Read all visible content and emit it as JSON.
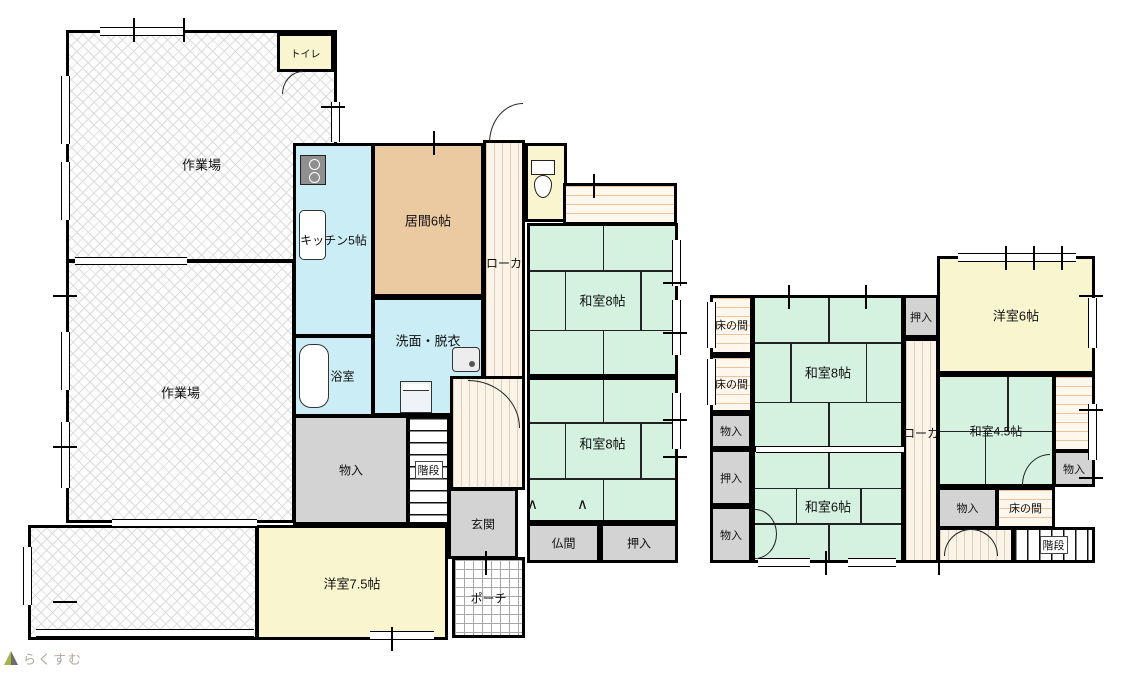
{
  "canvas": {
    "width": 1135,
    "height": 673
  },
  "logo": {
    "text": "らくすむ",
    "icon": "house-icon",
    "text_color": "#b3a69b"
  },
  "palette": {
    "tatami_green": "#d5f2e1",
    "water_cyan": "#cbedf5",
    "living_tan": "#ebc9a1",
    "western_cream": "#f9f5cf",
    "closet_gray": "#d3d3d3",
    "corridor_cream": "#f9f3e8",
    "engawa_stripe": "#edc49c",
    "wall_black": "#000000"
  },
  "floors": [
    {
      "id": "first-floor",
      "rooms": [
        {
          "id": "workshop-1",
          "label": "作業場",
          "type": "hatch",
          "rect": [
            66,
            30,
            271,
            232
          ],
          "ly": 58
        },
        {
          "id": "workshop-2",
          "label": "作業場",
          "type": "hatch",
          "rect": [
            66,
            260,
            229,
            263
          ]
        },
        {
          "id": "workshop-3",
          "label": "",
          "type": "hatch",
          "rect": [
            28,
            525,
            230,
            115
          ]
        },
        {
          "id": "toilet-upper",
          "label": "トイレ",
          "type": "cream",
          "rect": [
            277,
            33,
            57,
            39
          ],
          "fs": 10
        },
        {
          "id": "kitchen",
          "label": "キッチン5帖",
          "type": "cyan",
          "rect": [
            293,
            143,
            81,
            194
          ],
          "fs": 12
        },
        {
          "id": "living",
          "label": "居間6帖",
          "type": "tan",
          "rect": [
            372,
            143,
            112,
            154
          ]
        },
        {
          "id": "washroom",
          "label": "洗面・脱衣",
          "type": "cyan",
          "rect": [
            372,
            297,
            112,
            119
          ],
          "ly": 35
        },
        {
          "id": "bath",
          "label": "浴室",
          "type": "cyan",
          "rect": [
            293,
            335,
            81,
            82
          ],
          "fs": 12,
          "lx": 62
        },
        {
          "id": "corridor-1",
          "label": "ローカ",
          "type": "stripes-v",
          "rect": [
            483,
            140,
            42,
            278
          ],
          "ly": 44,
          "fs": 12
        },
        {
          "id": "hall-1",
          "label": "",
          "type": "stripes-v",
          "rect": [
            450,
            376,
            75,
            114
          ]
        },
        {
          "id": "toilet-lower",
          "label": "",
          "type": "cream",
          "rect": [
            525,
            143,
            42,
            79
          ]
        },
        {
          "id": "engawa-1",
          "label": "",
          "type": "stripes-h",
          "rect": [
            563,
            183,
            114,
            42
          ]
        },
        {
          "id": "washitsu-8-a",
          "label": "和室8帖",
          "type": "tatami tatami8",
          "rect": [
            527,
            223,
            151,
            154
          ]
        },
        {
          "id": "washitsu-8-b",
          "label": "和室8帖",
          "type": "tatami tatami8",
          "rect": [
            527,
            377,
            151,
            146
          ],
          "ly": 45
        },
        {
          "id": "storage-1f",
          "label": "物入",
          "type": "gray",
          "rect": [
            293,
            415,
            116,
            110
          ],
          "fs": 12
        },
        {
          "id": "stairs-1f",
          "label": "階段",
          "type": "stairs-h",
          "rect": [
            407,
            415,
            43,
            110
          ],
          "fs": 11,
          "boxed": true
        },
        {
          "id": "entrance",
          "label": "玄関",
          "type": "gray",
          "rect": [
            448,
            488,
            70,
            71
          ],
          "fs": 12
        },
        {
          "id": "porch",
          "label": "ポーチ",
          "type": "grid",
          "rect": [
            452,
            557,
            73,
            81
          ],
          "fs": 12
        },
        {
          "id": "western-7-5",
          "label": "洋室7.5帖",
          "type": "cream",
          "rect": [
            256,
            525,
            192,
            115
          ]
        },
        {
          "id": "butsuma",
          "label": "仏間",
          "type": "gray",
          "rect": [
            527,
            523,
            73,
            40
          ],
          "fs": 12
        },
        {
          "id": "oshiire-1f",
          "label": "押入",
          "type": "gray",
          "rect": [
            600,
            523,
            78,
            40
          ],
          "fs": 12
        }
      ]
    },
    {
      "id": "second-floor",
      "rooms": [
        {
          "id": "tokonoma-2f-a",
          "label": "床の間",
          "type": "stripes-h",
          "rect": [
            710,
            295,
            43,
            60
          ],
          "fs": 11
        },
        {
          "id": "tokonoma-2f-b",
          "label": "床の間",
          "type": "stripes-h",
          "rect": [
            710,
            355,
            43,
            58
          ],
          "fs": 11
        },
        {
          "id": "storage-2f-a",
          "label": "物入",
          "type": "gray",
          "rect": [
            710,
            413,
            42,
            36
          ],
          "fs": 11
        },
        {
          "id": "oshiire-2f-a",
          "label": "押入",
          "type": "gray",
          "rect": [
            710,
            449,
            42,
            57
          ],
          "fs": 11
        },
        {
          "id": "storage-2f-b",
          "label": "物入",
          "type": "gray",
          "rect": [
            710,
            506,
            42,
            57
          ],
          "fs": 11
        },
        {
          "id": "washitsu-8-c",
          "label": "和室8帖",
          "type": "tatami tatami8",
          "rect": [
            752,
            295,
            152,
            154
          ]
        },
        {
          "id": "washitsu-6",
          "label": "和室6帖",
          "type": "tatami tatami6",
          "rect": [
            752,
            449,
            152,
            114
          ]
        },
        {
          "id": "oshiire-2f-b",
          "label": "押入",
          "type": "gray",
          "rect": [
            903,
            295,
            36,
            43
          ],
          "fs": 11
        },
        {
          "id": "corridor-2",
          "label": "ローカ",
          "type": "stripes-v",
          "rect": [
            903,
            338,
            36,
            225
          ],
          "ly": 42,
          "fs": 12
        },
        {
          "id": "western-6",
          "label": "洋室6帖",
          "type": "cream",
          "rect": [
            937,
            256,
            158,
            118
          ]
        },
        {
          "id": "washitsu-4-5",
          "label": "和室4.5帖",
          "type": "tatami tatami45",
          "rect": [
            937,
            374,
            118,
            113
          ],
          "fs": 12
        },
        {
          "id": "engawa-2",
          "label": "",
          "type": "stripes-h",
          "rect": [
            1053,
            374,
            42,
            78
          ]
        },
        {
          "id": "storage-2f-c",
          "label": "物入",
          "type": "gray",
          "rect": [
            1053,
            450,
            42,
            37
          ],
          "fs": 11
        },
        {
          "id": "storage-2f-d",
          "label": "物入",
          "type": "gray",
          "rect": [
            937,
            487,
            61,
            42
          ],
          "fs": 11
        },
        {
          "id": "tokonoma-2f-c",
          "label": "床の間",
          "type": "stripes-h",
          "rect": [
            996,
            487,
            59,
            42
          ],
          "fs": 11
        },
        {
          "id": "hall-2",
          "label": "",
          "type": "stripes-v",
          "rect": [
            937,
            527,
            77,
            36
          ]
        },
        {
          "id": "stairs-2f",
          "label": "階段",
          "type": "stairs-v",
          "rect": [
            1012,
            527,
            83,
            36
          ],
          "fs": 11,
          "boxed": true
        }
      ]
    }
  ],
  "icons": [
    {
      "type": "stove",
      "rect": [
        300,
        155,
        26,
        30
      ]
    },
    {
      "type": "ksink",
      "rect": [
        299,
        210,
        27,
        50
      ]
    },
    {
      "type": "tub",
      "rect": [
        299,
        344,
        30,
        64
      ]
    },
    {
      "type": "basin",
      "rect": [
        452,
        347,
        28,
        25
      ]
    },
    {
      "type": "washer",
      "rect": [
        400,
        381,
        32,
        32
      ]
    },
    {
      "type": "toilet",
      "rect": [
        529,
        160,
        26,
        38
      ]
    }
  ],
  "doors": [
    {
      "rect": [
        489,
        103,
        34,
        40
      ],
      "corner": "tl"
    },
    {
      "rect": [
        282,
        71,
        21,
        23
      ],
      "corner": "tl"
    },
    {
      "rect": [
        468,
        380,
        52,
        48
      ],
      "corner": "tr"
    },
    {
      "rect": [
        1022,
        454,
        28,
        31
      ],
      "corner": "tl"
    },
    {
      "rect": [
        944,
        529,
        27,
        27
      ],
      "corner": "tl"
    },
    {
      "rect": [
        971,
        529,
        27,
        27
      ],
      "corner": "tr"
    },
    {
      "rect": [
        755,
        509,
        22,
        25
      ],
      "corner": "tr"
    },
    {
      "rect": [
        755,
        534,
        22,
        25
      ],
      "corner": "br"
    }
  ],
  "marks": [
    {
      "g": "∧",
      "x": 527,
      "y": 497
    },
    {
      "g": "∧",
      "x": 577,
      "y": 497
    }
  ],
  "windows": {
    "h": [
      [
        100,
        27,
        85,
        9
      ],
      [
        75,
        257,
        112,
        8
      ],
      [
        112,
        519,
        145,
        8
      ],
      [
        36,
        629,
        218,
        8
      ],
      [
        370,
        631,
        64,
        9
      ],
      [
        758,
        558,
        52,
        9
      ],
      [
        848,
        558,
        48,
        9
      ],
      [
        958,
        253,
        118,
        9
      ],
      [
        756,
        446,
        148,
        7
      ]
    ],
    "v": [
      [
        61,
        76,
        9,
        68
      ],
      [
        61,
        162,
        9,
        58
      ],
      [
        61,
        332,
        9,
        58
      ],
      [
        61,
        422,
        9,
        66
      ],
      [
        23,
        547,
        9,
        58
      ],
      [
        331,
        102,
        9,
        40
      ],
      [
        672,
        240,
        9,
        46
      ],
      [
        672,
        300,
        9,
        55
      ],
      [
        672,
        393,
        9,
        56
      ],
      [
        1088,
        298,
        9,
        50
      ],
      [
        1088,
        404,
        9,
        56
      ],
      [
        707,
        302,
        9,
        46
      ],
      [
        707,
        359,
        9,
        46
      ]
    ]
  },
  "ticks": {
    "v": [
      [
        133,
        18
      ],
      [
        183,
        18
      ],
      [
        433,
        131
      ],
      [
        593,
        174
      ],
      [
        1005,
        246
      ],
      [
        1033,
        246
      ],
      [
        1061,
        246
      ],
      [
        788,
        285
      ],
      [
        865,
        285
      ],
      [
        825,
        551
      ],
      [
        938,
        551
      ],
      [
        391,
        627
      ],
      [
        485,
        551
      ]
    ],
    "h": [
      [
        53,
        295
      ],
      [
        53,
        446
      ],
      [
        53,
        601
      ],
      [
        321,
        106
      ],
      [
        663,
        282
      ],
      [
        663,
        332
      ],
      [
        663,
        419
      ],
      [
        663,
        456
      ],
      [
        1079,
        295
      ],
      [
        1079,
        409
      ],
      [
        1079,
        477
      ]
    ]
  }
}
